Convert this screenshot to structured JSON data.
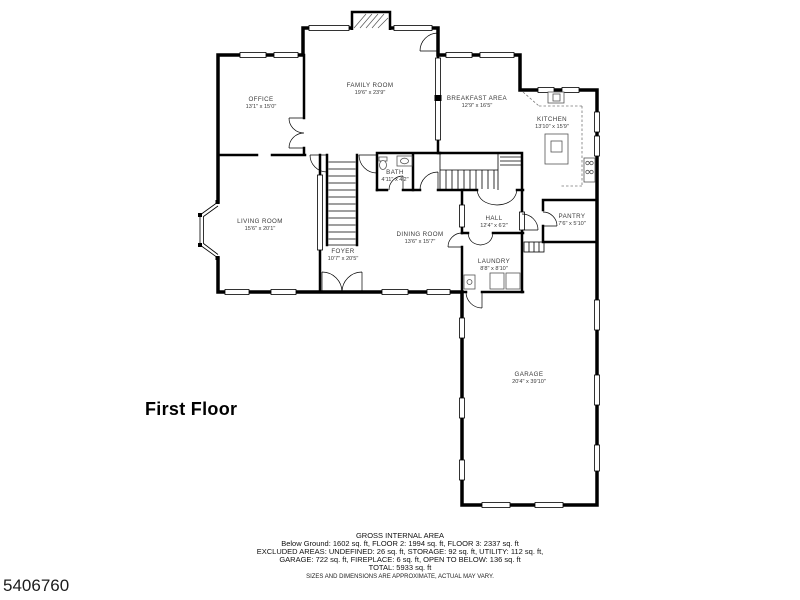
{
  "page": {
    "floor_label": "First Floor",
    "photo_id": "5406760",
    "wall_color": "#000000",
    "background": "#ffffff"
  },
  "rooms": [
    {
      "name": "OFFICE",
      "dims": "13'1\" x 15'0\""
    },
    {
      "name": "FAMILY ROOM",
      "dims": "19'6\" x 23'9\""
    },
    {
      "name": "BREAKFAST AREA",
      "dims": "12'9\" x 16'5\""
    },
    {
      "name": "KITCHEN",
      "dims": "13'10\" x 15'9\""
    },
    {
      "name": "LIVING ROOM",
      "dims": "15'6\" x 20'1\""
    },
    {
      "name": "FOYER",
      "dims": "10'7\" x 20'5\""
    },
    {
      "name": "BATH",
      "dims": "4'11\" x 4'2\""
    },
    {
      "name": "DINING ROOM",
      "dims": "13'6\" x 15'7\""
    },
    {
      "name": "HALL",
      "dims": "12'4\" x 6'2\""
    },
    {
      "name": "PANTRY",
      "dims": "7'6\" x 5'10\""
    },
    {
      "name": "LAUNDRY",
      "dims": "8'8\" x 8'10\""
    },
    {
      "name": "GARAGE",
      "dims": "20'4\" x 39'10\""
    }
  ],
  "footer": {
    "title": "GROSS INTERNAL AREA",
    "lines": [
      "Below Ground: 1602 sq. ft, FLOOR 2: 1994 sq. ft, FLOOR 3: 2337 sq. ft",
      "EXCLUDED AREAS: UNDEFINED: 26 sq. ft, STORAGE: 92 sq. ft, UTILITY: 112 sq. ft,",
      "GARAGE: 722 sq. ft, FIREPLACE: 6 sq. ft, OPEN TO BELOW: 136 sq. ft",
      "TOTAL: 5933 sq. ft"
    ],
    "disclaimer": "SIZES AND DIMENSIONS ARE APPROXIMATE, ACTUAL MAY VARY."
  }
}
